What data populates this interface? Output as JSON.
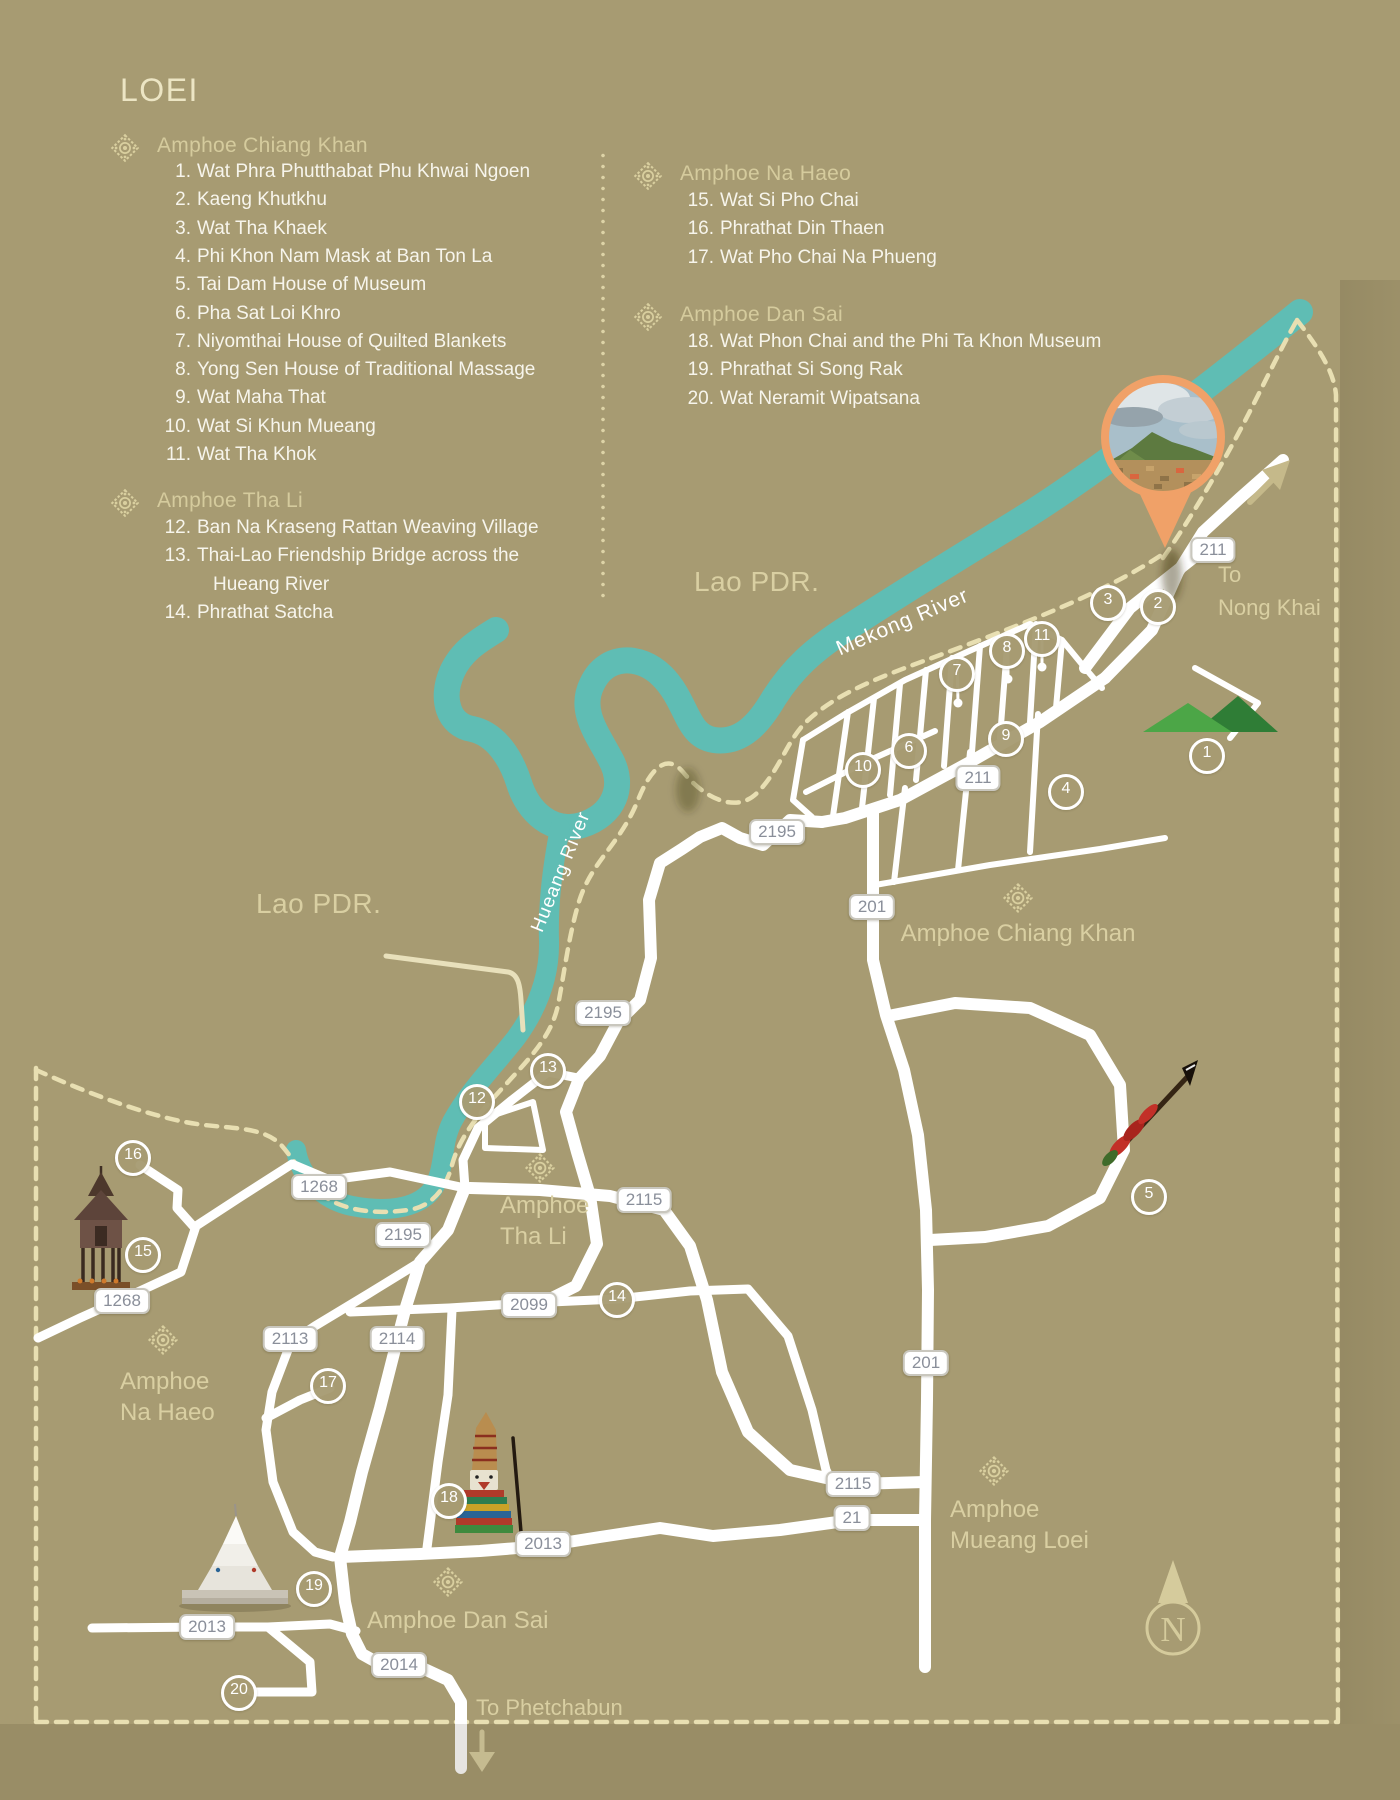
{
  "title": "LOEI",
  "legend": {
    "sections": [
      {
        "name": "Amphoe Chiang Khan",
        "x": 157,
        "y": 134,
        "orn_x": 125,
        "orn_y": 148,
        "items_y": 161,
        "items": [
          {
            "n": "1.",
            "label": "Wat Phra Phutthabat Phu Khwai Ngoen"
          },
          {
            "n": "2.",
            "label": "Kaeng Khutkhu"
          },
          {
            "n": "3.",
            "label": "Wat Tha Khaek"
          },
          {
            "n": "4.",
            "label": "Phi Khon Nam Mask at Ban Ton La"
          },
          {
            "n": "5.",
            "label": "Tai Dam House of Museum"
          },
          {
            "n": "6.",
            "label": "Pha Sat Loi Khro"
          },
          {
            "n": "7.",
            "label": "Niyomthai House of Quilted Blankets"
          },
          {
            "n": "8.",
            "label": "Yong Sen House of Traditional Massage"
          },
          {
            "n": "9.",
            "label": "Wat Maha That"
          },
          {
            "n": "10.",
            "label": "Wat Si Khun Mueang"
          },
          {
            "n": "11.",
            "label": "Wat Tha Khok"
          }
        ]
      },
      {
        "name": "Amphoe Tha Li",
        "x": 157,
        "y": 489,
        "orn_x": 125,
        "orn_y": 503,
        "items_y": 517,
        "items": [
          {
            "n": "12.",
            "label": "Ban Na Kraseng Rattan Weaving Village"
          },
          {
            "n": "13.",
            "label": "Thai-Lao Friendship Bridge across the"
          },
          {
            "n": "",
            "label": "Hueang River",
            "indent": true
          },
          {
            "n": "14.",
            "label": "Phrathat Satcha"
          }
        ]
      },
      {
        "name": "Amphoe Na Haeo",
        "x": 680,
        "y": 162,
        "orn_x": 648,
        "orn_y": 176,
        "items_y": 190,
        "items": [
          {
            "n": "15.",
            "label": "Wat Si Pho Chai"
          },
          {
            "n": "16.",
            "label": "Phrathat Din Thaen"
          },
          {
            "n": "17.",
            "label": "Wat Pho Chai Na Phueng"
          }
        ]
      },
      {
        "name": "Amphoe Dan Sai",
        "x": 680,
        "y": 303,
        "orn_x": 648,
        "orn_y": 317,
        "items_y": 331,
        "items": [
          {
            "n": "18.",
            "label": "Wat Phon Chai and the Phi Ta Khon Museum"
          },
          {
            "n": "19.",
            "label": "Phrathat Si Song Rak"
          },
          {
            "n": "20.",
            "label": "Wat Neramit Wipatsana"
          }
        ]
      }
    ]
  },
  "map": {
    "labels": {
      "lao_pdr_west": "Lao PDR.",
      "lao_pdr_north": "Lao PDR.",
      "mekong_river": "Mekong River",
      "hueang_river": "Hueang River",
      "to_nong_khai_1": "To",
      "to_nong_khai_2": "Nong Khai",
      "to_phetchabun": "To Phetchabun",
      "chiang_khan": "Amphoe Chiang Khan",
      "tha_li_1": "Amphoe",
      "tha_li_2": "Tha Li",
      "na_haeo_1": "Amphoe",
      "na_haeo_2": "Na Haeo",
      "dan_sai": "Amphoe Dan Sai",
      "mueang_loei_1": "Amphoe",
      "mueang_loei_2": "Mueang Loei",
      "compass_n": "N"
    },
    "route_badges": [
      {
        "route": "211",
        "x": 1213,
        "y": 550
      },
      {
        "route": "211",
        "x": 978,
        "y": 778
      },
      {
        "route": "2195",
        "x": 777,
        "y": 832
      },
      {
        "route": "2195",
        "x": 603,
        "y": 1013
      },
      {
        "route": "2195",
        "x": 403,
        "y": 1235
      },
      {
        "route": "201",
        "x": 872,
        "y": 907
      },
      {
        "route": "201",
        "x": 926,
        "y": 1363
      },
      {
        "route": "2115",
        "x": 644,
        "y": 1200
      },
      {
        "route": "2115",
        "x": 853,
        "y": 1484
      },
      {
        "route": "21",
        "x": 852,
        "y": 1518
      },
      {
        "route": "1268",
        "x": 319,
        "y": 1187
      },
      {
        "route": "1268",
        "x": 122,
        "y": 1301
      },
      {
        "route": "2113",
        "x": 290,
        "y": 1339
      },
      {
        "route": "2114",
        "x": 397,
        "y": 1339
      },
      {
        "route": "2099",
        "x": 529,
        "y": 1305
      },
      {
        "route": "2013",
        "x": 543,
        "y": 1544
      },
      {
        "route": "2013",
        "x": 207,
        "y": 1627
      },
      {
        "route": "2014",
        "x": 399,
        "y": 1665
      }
    ],
    "poi_markers": [
      {
        "n": "1",
        "x": 1207,
        "y": 756
      },
      {
        "n": "2",
        "x": 1158,
        "y": 607
      },
      {
        "n": "3",
        "x": 1108,
        "y": 603
      },
      {
        "n": "4",
        "x": 1066,
        "y": 792
      },
      {
        "n": "5",
        "x": 1149,
        "y": 1197
      },
      {
        "n": "6",
        "x": 909,
        "y": 751
      },
      {
        "n": "7",
        "x": 957,
        "y": 674
      },
      {
        "n": "8",
        "x": 1007,
        "y": 651
      },
      {
        "n": "9",
        "x": 1006,
        "y": 739
      },
      {
        "n": "10",
        "x": 863,
        "y": 770
      },
      {
        "n": "11",
        "x": 1042,
        "y": 639
      },
      {
        "n": "12",
        "x": 477,
        "y": 1102
      },
      {
        "n": "13",
        "x": 548,
        "y": 1071
      },
      {
        "n": "14",
        "x": 617,
        "y": 1300
      },
      {
        "n": "15",
        "x": 143,
        "y": 1255
      },
      {
        "n": "16",
        "x": 133,
        "y": 1158
      },
      {
        "n": "17",
        "x": 328,
        "y": 1386
      },
      {
        "n": "18",
        "x": 449,
        "y": 1501
      },
      {
        "n": "19",
        "x": 314,
        "y": 1589
      },
      {
        "n": "20",
        "x": 239,
        "y": 1693
      }
    ],
    "ornaments": [
      {
        "x": 1018,
        "y": 898
      },
      {
        "x": 540,
        "y": 1168
      },
      {
        "x": 163,
        "y": 1340
      },
      {
        "x": 448,
        "y": 1582
      },
      {
        "x": 994,
        "y": 1471
      }
    ],
    "icons": [
      "photo-location-marker",
      "mountain-icon",
      "spear-icon",
      "phi-ta-khon-mask-icon",
      "temple-shrine-icon",
      "white-pagoda-icon",
      "compass-rose",
      "northeast-arrow-icon",
      "south-arrow-icon"
    ],
    "colors": {
      "background": "#a79b72",
      "river": "#5fbdb4",
      "road": "#ffffff",
      "border_trail": "#e8dfb2",
      "cream_text": "#d9cfa2",
      "list_text": "#f7f5ec",
      "badge_text": "#8a8f9a",
      "marker_orange": "#f0a168",
      "mountain_light": "#4ca647",
      "mountain_dark": "#2f7d36"
    }
  }
}
